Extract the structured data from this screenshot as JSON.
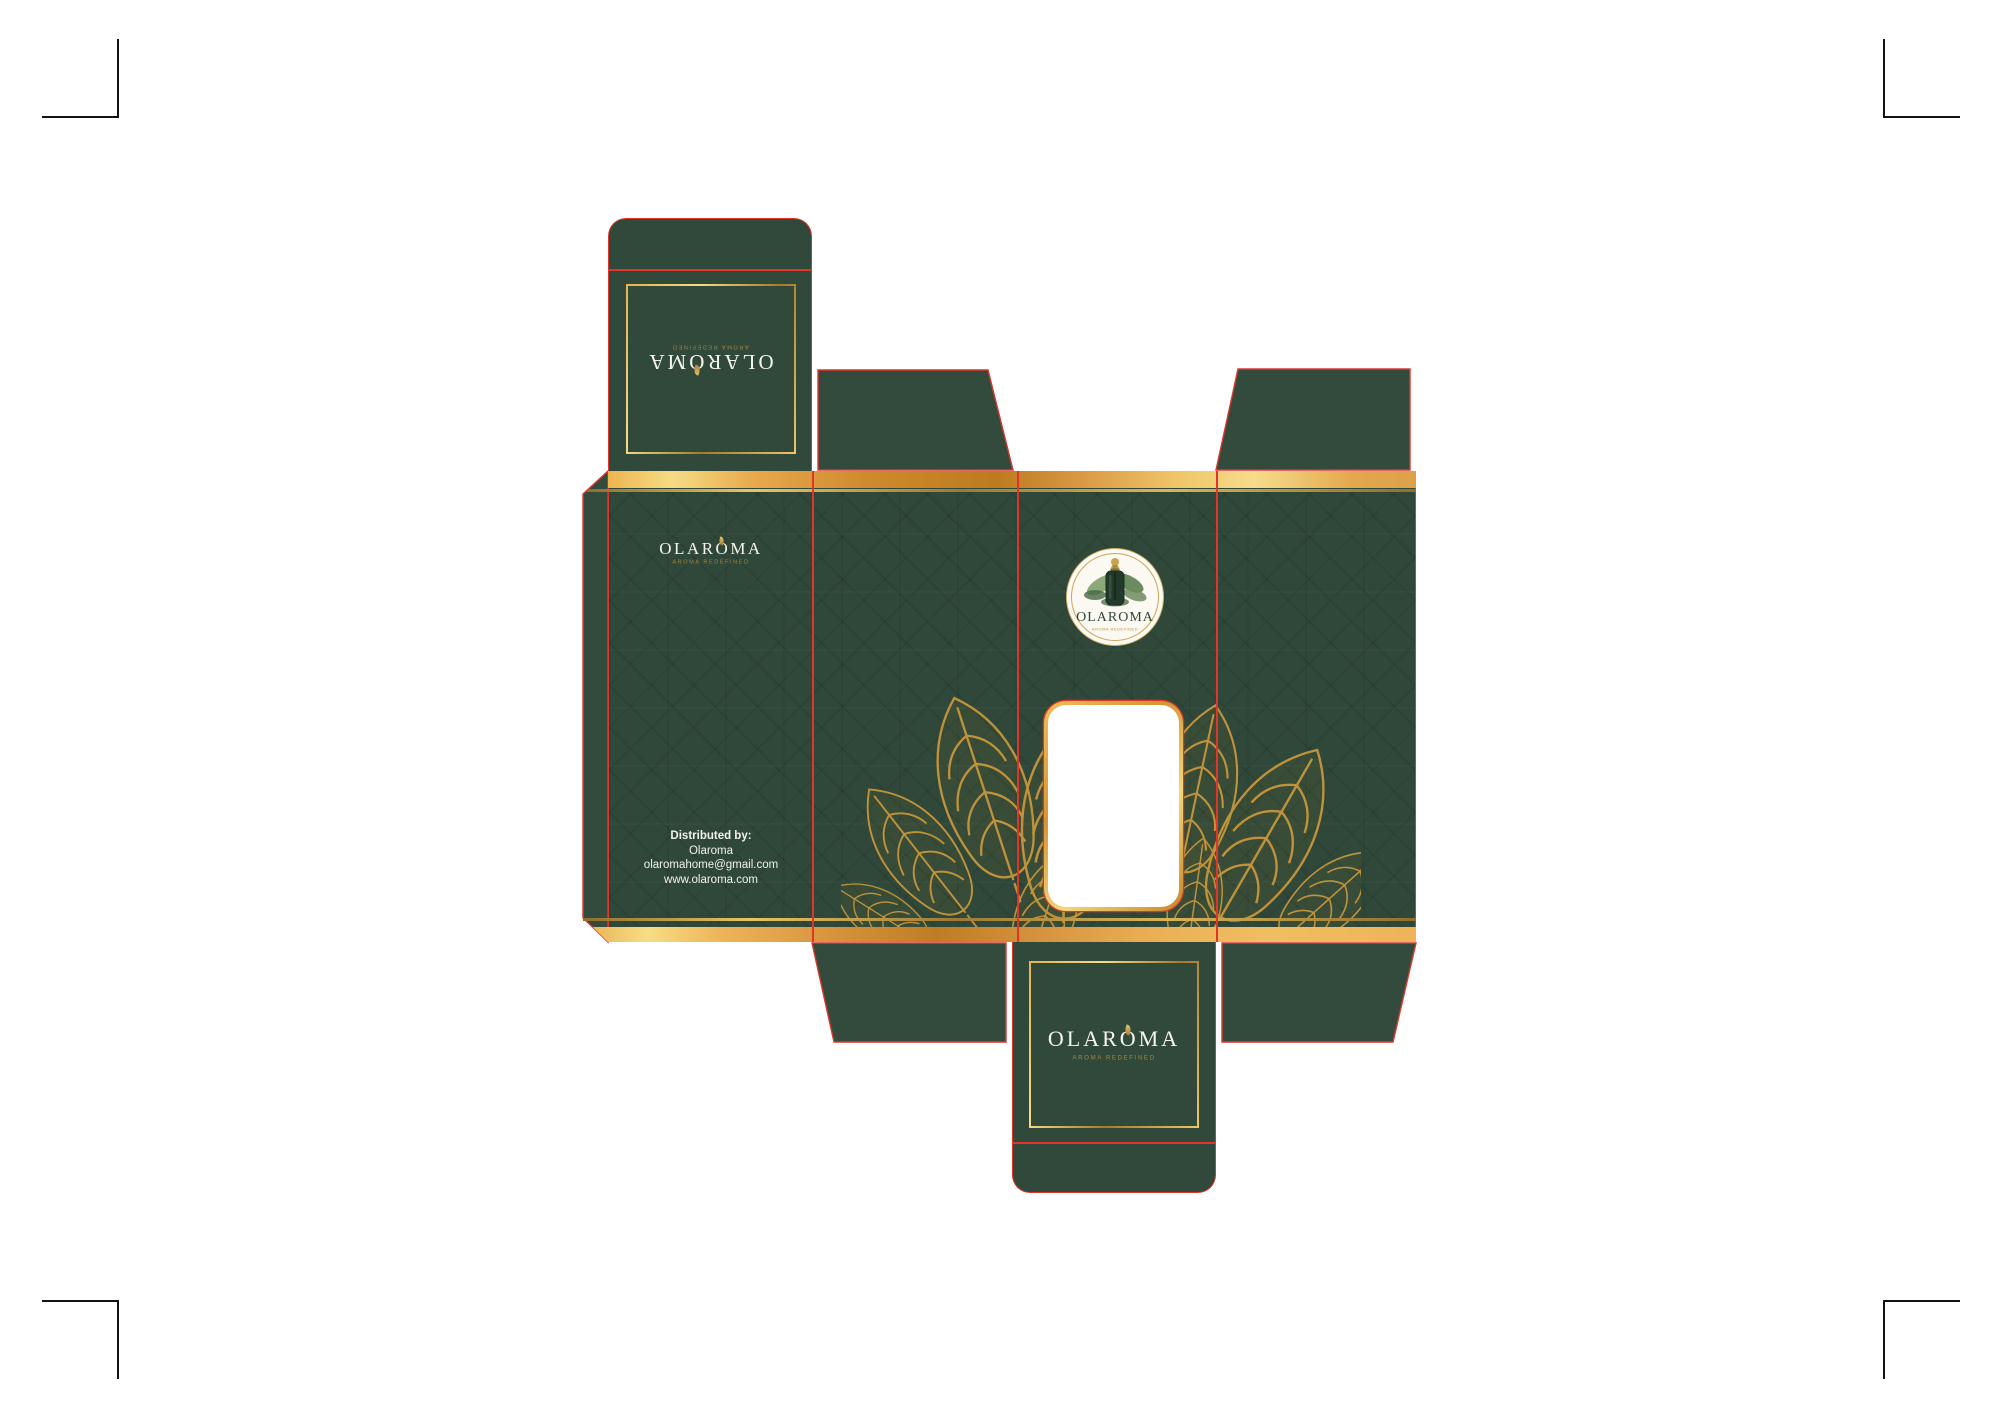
{
  "brand": {
    "name": "OLAROMA",
    "tagline": "AROMA REDEFINED"
  },
  "back_panel": {
    "distributed_by_label": "Distributed by:",
    "distributor_name": "Olaroma",
    "email": "olaromahome@gmail.com",
    "website": "www.olaroma.com"
  },
  "badge": {
    "brand": "OLAROMA",
    "tagline": "AROMA REDEFINED"
  },
  "icons": {
    "wordmark_leaf": "leaf-ornament-icon",
    "badge_bottle": "dropper-bottle-icon",
    "badge_leaves": "watercolor-leaves-icon",
    "window_leaves": "gold-leaf-lineart-icon"
  },
  "colors": {
    "panel_green": "#2f4839",
    "flap_green": "#334b3c",
    "dieline_red": "#e0352b",
    "gold": "#c9a24c",
    "gold_band_light": "#f6dc85",
    "gold_band_dark": "#c07c22",
    "tagline_gold": "#a8853f",
    "badge_background": "#fcf9f2",
    "badge_text_green": "#2e4734",
    "wordmark_white": "#f6f4ee",
    "crop_mark_black": "#121212",
    "canvas_white": "#ffffff"
  }
}
